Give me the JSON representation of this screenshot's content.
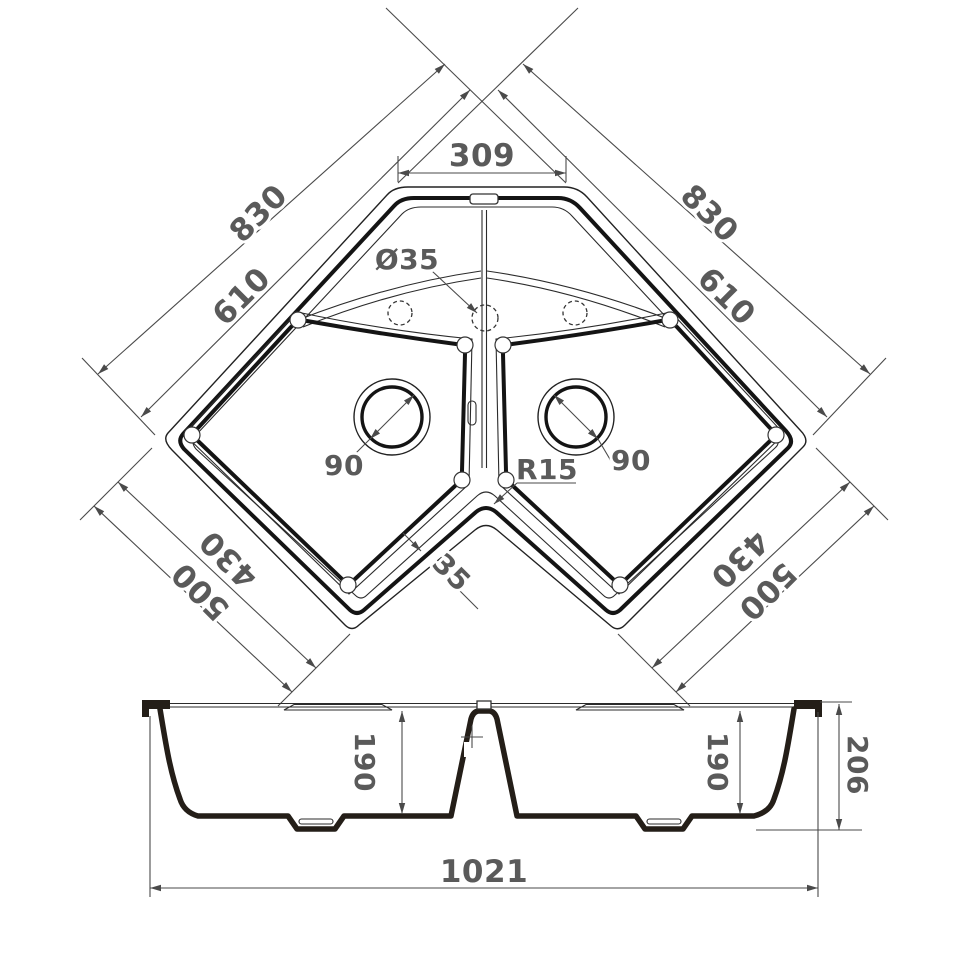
{
  "plan": {
    "top_width": "309",
    "left_outer_edge": "830",
    "left_inner_edge": "610",
    "right_outer_edge": "830",
    "right_inner_edge": "610",
    "lower_left_outer": "500",
    "lower_left_inner": "430",
    "lower_right_outer": "500",
    "lower_right_inner": "430",
    "left_drain": "90",
    "right_drain": "90",
    "faucet_hole": "Ø35",
    "inner_corner_radius": "R15",
    "divider_wall": "35"
  },
  "section": {
    "left_depth": "190",
    "right_depth": "190",
    "overall_height": "206",
    "overall_width": "1021"
  },
  "colors": {
    "outline": "#141414",
    "profile": "#241e18",
    "dimension_line": "#4a4a4a",
    "dimension_text": "#5a5a5a",
    "background": "#ffffff"
  }
}
